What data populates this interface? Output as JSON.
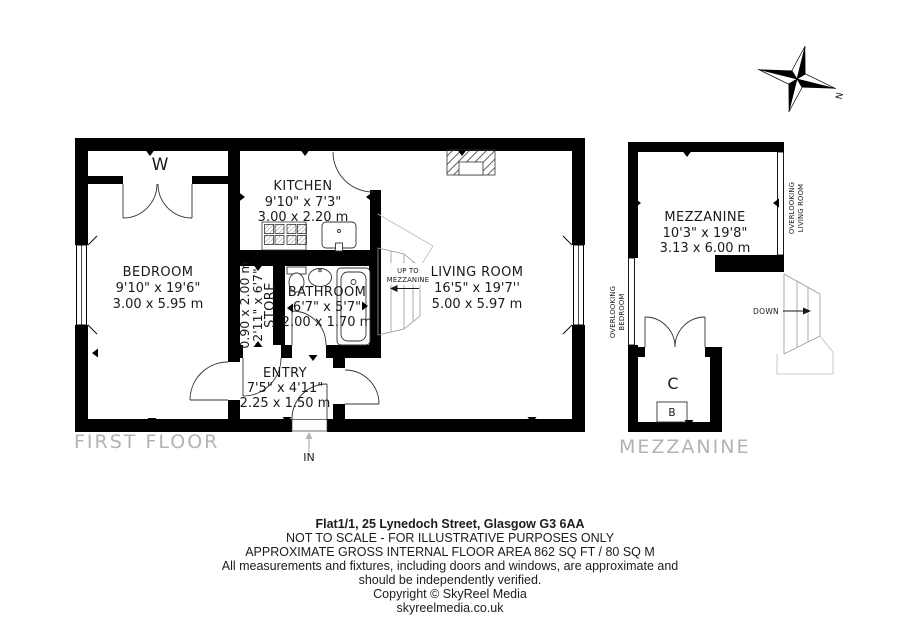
{
  "first_floor": {
    "floor_label": "FIRST FLOOR",
    "bedroom": {
      "name": "BEDROOM",
      "imperial": "9'10\" x 19'6\"",
      "metric": "3.00 x 5.95 m"
    },
    "kitchen": {
      "name": "KITCHEN",
      "imperial": "9'10\" x 7'3\"",
      "metric": "3.00 x 2.20 m"
    },
    "living_room": {
      "name": "LIVING ROOM",
      "imperial": "16'5\" x 19'7''",
      "metric": "5.00 x 5.97 m"
    },
    "bathroom": {
      "name": "BATHROOM",
      "imperial": "6'7\" x 5'7\"",
      "metric": "2.00 x 1.70 m"
    },
    "store": {
      "name": "STORE",
      "imperial": "2'11\" x 6'7\"",
      "metric": "0.90 x 2.00 m"
    },
    "entry": {
      "name": "ENTRY",
      "imperial": "7'5\" x 4'11\"",
      "metric": "2.25 x 1.50 m"
    },
    "wardrobe_label": "W",
    "entrance_label": "IN",
    "stairs_up_line1": "UP TO",
    "stairs_up_line2": "MEZZANINE"
  },
  "mezzanine_floor": {
    "floor_label": "MEZZANINE",
    "mezzanine": {
      "name": "MEZZANINE",
      "imperial": "10'3\" x 19'8\"",
      "metric": "3.13 x 6.00 m"
    },
    "cupboard_label": "C",
    "boiler_label": "B",
    "stairs_down_label": "DOWN",
    "overlooking_living_line1": "OVERLOOKING",
    "overlooking_living_line2": "LIVING ROOM",
    "overlooking_bedroom_line1": "OVERLOOKING",
    "overlooking_bedroom_line2": "BEDROOM"
  },
  "compass": {
    "north_label": "N"
  },
  "title_block": {
    "address": "Flat1/1, 25 Lynedoch Street, Glasgow G3 6AA",
    "scale_note": "NOT TO SCALE - FOR ILLUSTRATIVE PURPOSES ONLY",
    "area_note": "APPROXIMATE GROSS INTERNAL FLOOR AREA 862 SQ FT / 80 SQ M",
    "disclaimer_line1": "All measurements and fixtures, including doors and windows, are approximate and",
    "disclaimer_line2": "should be independently verified.",
    "copyright": "Copyright © SkyReel Media",
    "website": "skyreelmedia.co.uk"
  },
  "colors": {
    "wall": "#000000",
    "line": "#333333",
    "light_line": "#999999",
    "floor_label_gray": "#b3b3b3"
  }
}
